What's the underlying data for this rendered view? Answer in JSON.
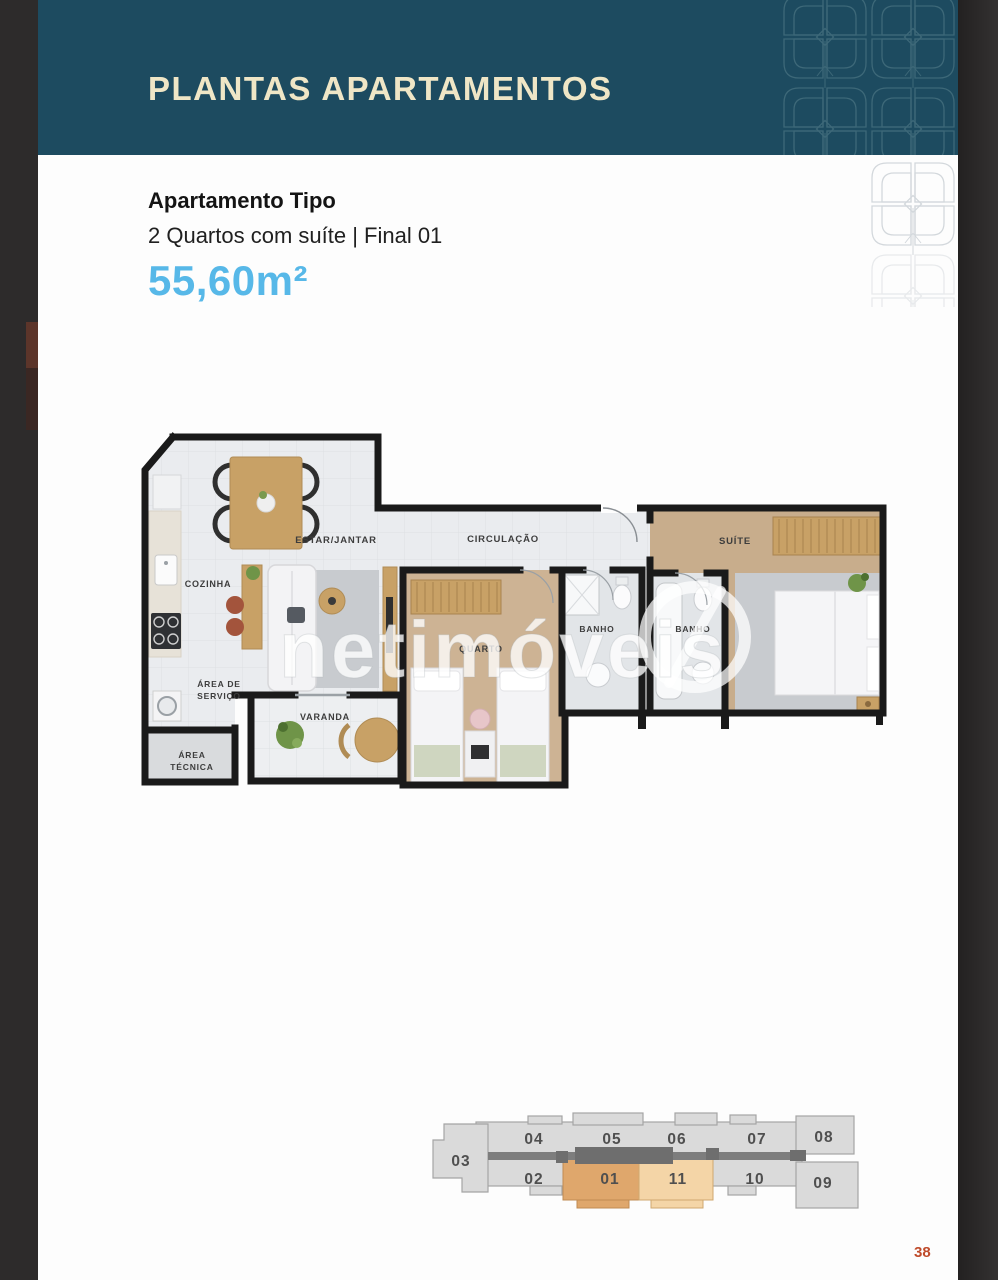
{
  "page": {
    "header": {
      "title": "PLANTAS APARTAMENTOS"
    },
    "apartment": {
      "type_label": "Apartamento Tipo",
      "subtitle": "2 Quartos com suíte | Final 01",
      "area": "55,60m²"
    },
    "floor_plan": {
      "watermark": "netimóveis",
      "rooms": {
        "estar_jantar": "ESTAR/JANTAR",
        "circulacao": "CIRCULAÇÃO",
        "cozinha": "COZINHA",
        "suite": "SUÍTE",
        "banho_social": "BANHO",
        "banho_suite": "BANHO",
        "quarto": "QUARTO",
        "varanda": "VARANDA",
        "area_servico_l1": "ÁREA DE",
        "area_servico_l2": "SERVIÇO",
        "area_tecnica_l1": "ÁREA",
        "area_tecnica_l2": "TÉCNICA"
      }
    },
    "key_plan": {
      "unit_left": "03",
      "units_top": [
        "04",
        "05",
        "06",
        "07",
        "08"
      ],
      "units_bottom": [
        "02",
        "01",
        "11",
        "10",
        "09"
      ],
      "highlight_unit": "01",
      "secondary_highlight_unit": "11"
    },
    "page_number": "38",
    "colors": {
      "header_bg": "#1d4b60",
      "header_text": "#efe6c6",
      "area_text": "#57b8e8",
      "page_number": "#bf4b2b",
      "unit_01_fill": "#dfa76c",
      "unit_11_fill": "#f4d5a7",
      "corridor": "#6e6e6e"
    }
  }
}
